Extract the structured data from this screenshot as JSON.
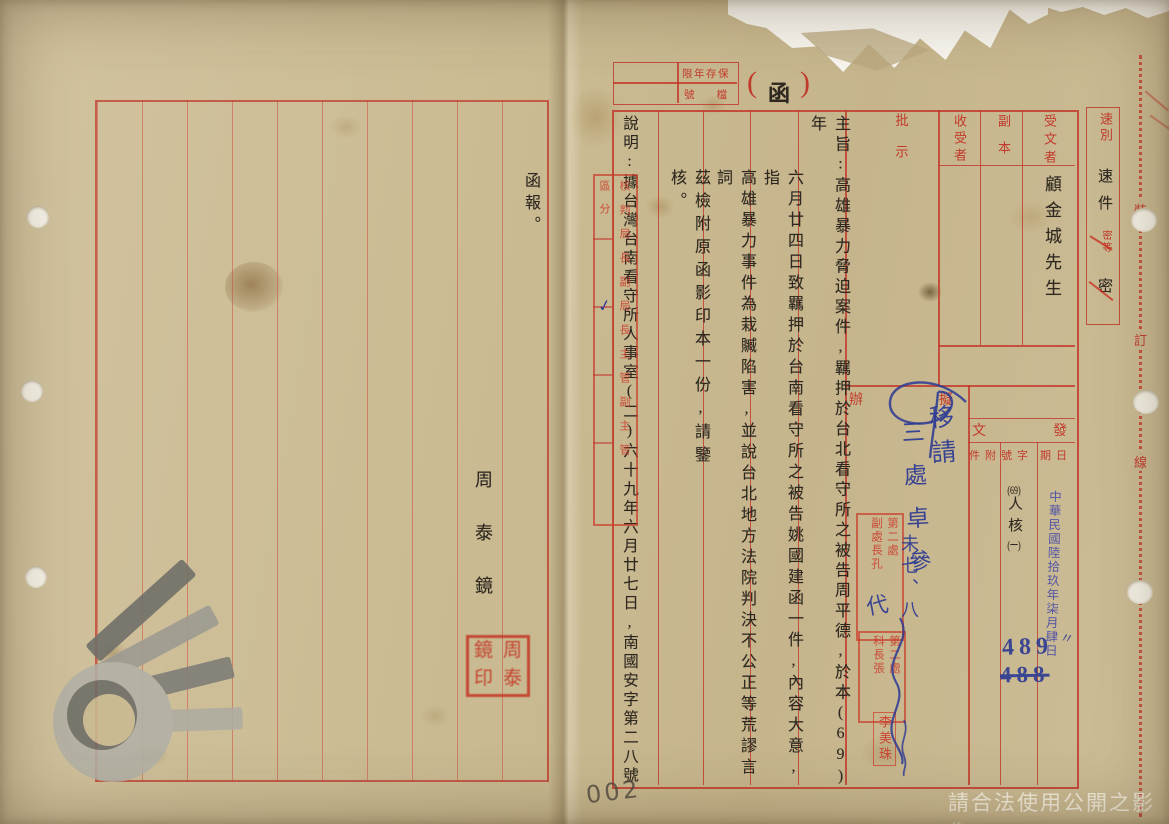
{
  "notice": {
    "watermark": "請合法使用公開之影像",
    "pencil_number": "002"
  },
  "binding": {
    "chars": [
      "裝",
      "訂",
      "線"
    ]
  },
  "left_page": {
    "opening": "函報。",
    "signer": "周泰鏡",
    "seal_chars": [
      "鏡",
      "周",
      "印",
      "泰"
    ]
  },
  "form": {
    "retention_label": "限年存保",
    "file_label": "號檔",
    "paren_open": "(",
    "doc_type": "函",
    "paren_close": ")",
    "speed_label": "速別",
    "speed_value": "速件",
    "secrecy_label": "密等",
    "secrecy_value": "密",
    "recipient_label": "受文者",
    "recipient_value": "顧金城先生",
    "copy_label": "副本",
    "copy_to_label": "收受者",
    "remark_label": "批示",
    "draft_right": "擬",
    "draft_left": "辦",
    "dispatch_right": "發",
    "dispatch_left": "文",
    "attach_label": "件附",
    "number_label": "號字",
    "date_label": "期日"
  },
  "body": {
    "col1": "主旨:高雄暴力脅迫案件,羈押於台北看守所之被告周平德,於本(69)年",
    "col2": "六月廿四日致羈押於台南看守所之被告姚國建函一件,內容大意,指",
    "col3": "高雄暴力事件為栽贓陷害,並說台北地方法院判決不公正等荒謬言詞",
    "col4": "茲檢附原函影印本一份,請鑒核。",
    "col5": "說明:據台灣台南看守所人事室(二)六十九年六月廿七日,南國安字第二八號"
  },
  "dispatch": {
    "number_top": "(69)",
    "number_mid": "人核",
    "number_bot": "(一)",
    "date_stamp": "中華民國陸拾玖年柒月肆日",
    "serial_new": "489",
    "serial_old": "488"
  },
  "annotations": {
    "draft_note_1": "移請",
    "draft_note_2": "三處卓參",
    "over_stamp_1": "未七、八",
    "over_stamp_2": "代",
    "check": "✓",
    "ditto": "〃"
  },
  "stamps": {
    "routing_header": "區分",
    "routing_body": "核判局長副局長主管副主管",
    "dept_a": "第二處\n副處長孔",
    "dept_b": "第二處\n科長張",
    "name_seal": "李美珠"
  }
}
